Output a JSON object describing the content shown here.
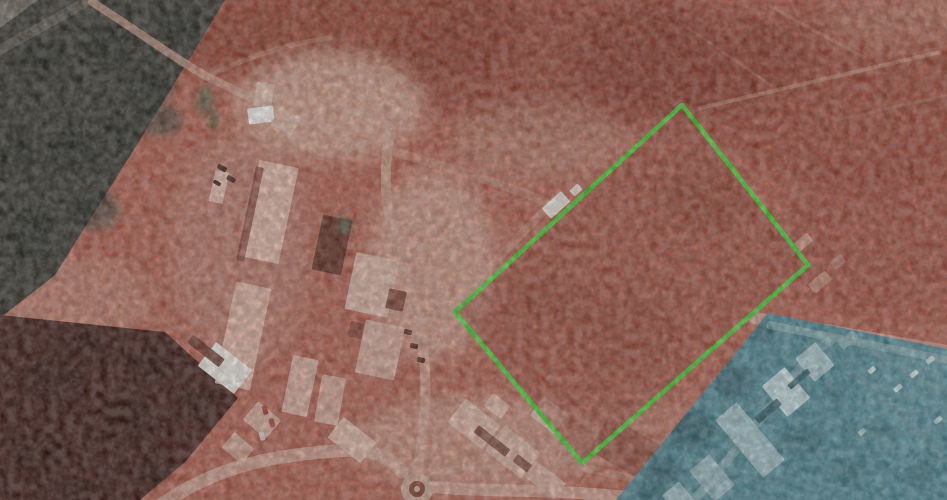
{
  "scene": {
    "type": "annotated-satellite-aerial-photograph",
    "width": 947,
    "height": 500,
    "notes": "red-brown tinted aerial view; bright green quadrilateral outlines a dirt sports field; teal-blue tinted sector in lower right; building compound on left; roundabout at bottom; scrub vegetation in upper-left and lower-left"
  },
  "map": {
    "palette": {
      "base": "#b45b48",
      "boundary_green": "#3ed32a",
      "blue_wash": "#4b8793",
      "road_light": "#d6a28e",
      "building_pink": "#e2b3a1",
      "building_white": "#f4ece2",
      "veg_olive": "#625d4d",
      "veg_dark_red": "#74281b",
      "shadow_dark": "#5e2317"
    },
    "field_boundary": {
      "points": "682,105 808,265 582,463 455,312",
      "stroke": "#3ed32a",
      "stroke_width": 4.5,
      "fill": "#9a4634",
      "fill_opacity": 0.55
    },
    "field_detail": {
      "streak_format": "[path, stroke, width, opacity]",
      "streaks": [
        [
          "M500,302 L688,172",
          "#b5705c",
          6,
          0.22
        ],
        [
          "M543,380 L738,243",
          "#b5705c",
          5,
          0.16
        ],
        [
          "M610,420 L778,282",
          "#b5705c",
          4,
          0.14
        ]
      ],
      "blotch_format": "[cx, cy, rx, ry, fill, opacity]",
      "blotches": [
        [
          700,
          200,
          45,
          30,
          "#8a3a28",
          0.5
        ],
        [
          622,
          330,
          55,
          40,
          "#93402e",
          0.45
        ],
        [
          540,
          300,
          35,
          25,
          "#8e3c2a",
          0.4
        ]
      ]
    },
    "blue_sector": {
      "points": "768,313 947,349 947,500 616,500",
      "fill": "#4b8793",
      "tree_fill": "#2f5f6a",
      "tree_format": "[cx, cy, rx, ry, opacity]",
      "trees": [
        [
          690,
          430,
          24,
          20,
          0.9
        ],
        [
          733,
          382,
          18,
          16,
          0.85
        ],
        [
          662,
          470,
          16,
          14,
          0.9
        ],
        [
          702,
          352,
          14,
          12,
          0.75
        ],
        [
          762,
          332,
          13,
          10,
          0.7
        ],
        [
          802,
          442,
          22,
          16,
          0.5
        ],
        [
          852,
          472,
          17,
          13,
          0.45
        ],
        [
          882,
          432,
          12,
          10,
          0.45
        ],
        [
          922,
          472,
          15,
          11,
          0.45
        ],
        [
          832,
          392,
          11,
          9,
          0.4
        ],
        [
          648,
          492,
          14,
          10,
          0.8
        ]
      ],
      "building_format": "[cx, cy, w, h, rot, fill, opacity?]",
      "buildings": [
        [
          750,
          440,
          28,
          75,
          -40,
          "#9fc2c9"
        ],
        [
          786,
          392,
          30,
          40,
          -40,
          "#c2dcdf"
        ],
        [
          815,
          362,
          26,
          30,
          -40,
          "#a7c9cf"
        ],
        [
          712,
          478,
          26,
          40,
          -40,
          "#94b7bf"
        ],
        [
          680,
          500,
          22,
          30,
          -40,
          "#9abcc3"
        ],
        [
          768,
          411,
          30,
          8,
          -40,
          "#2c5a66",
          0.9
        ],
        [
          799,
          379,
          26,
          6,
          -40,
          "#2c5a66",
          0.85
        ],
        [
          848,
          340,
          20,
          10,
          -40,
          "#8fb3b8",
          0.8
        ]
      ],
      "road_format": "[path, stroke, width, opacity]",
      "roads": [
        [
          "M690,505 C722,468 752,430 782,392 C802,364 817,347 832,340",
          "#7fa6ab",
          9,
          0.8
        ],
        [
          "M770,325 L947,360",
          "#8fb3b8",
          8,
          0.7
        ],
        [
          "M850,372 C892,402 922,432 942,462",
          "#6f9aa0",
          7,
          0.5
        ],
        [
          "M870,349 C900,370 930,386 947,392",
          "#6f9aa0",
          5,
          0.4
        ]
      ],
      "light_patch_format": "[cx, cy, rx, ry, fill, opacity]",
      "light_patches": [
        [
          902,
          405,
          42,
          55,
          "#5d96a1",
          0.55
        ],
        [
          940,
          370,
          30,
          25,
          "#6ba0aa",
          0.5
        ]
      ]
    },
    "vegetation": {
      "top_left": {
        "points": "0,0 225,0 140,140 55,275 0,318",
        "fill": "#625d4d"
      },
      "corner_strip": {
        "points": "0,0 38,0 0,28",
        "fill": "#d9cdb4"
      },
      "corner_band": [
        "M-4,52 L100,-6",
        "#cdbfa6",
        10,
        0.7
      ],
      "olive_blotch_fill": "#3e4034",
      "olive_blotch_format": "[cx, cy, rx, ry]",
      "olive_blotches": [
        [
          40,
          60,
          25,
          18
        ],
        [
          110,
          45,
          30,
          20
        ],
        [
          70,
          150,
          28,
          22
        ],
        [
          30,
          235,
          22,
          28
        ],
        [
          150,
          85,
          26,
          18
        ],
        [
          95,
          210,
          24,
          20
        ],
        [
          178,
          28,
          20,
          14
        ],
        [
          120,
          130,
          20,
          16
        ],
        [
          18,
          150,
          16,
          22
        ],
        [
          160,
          120,
          22,
          16
        ]
      ],
      "bottom_left": {
        "points": "0,315 165,332 238,398 185,462 140,500 0,500",
        "fill": "#74281b"
      },
      "red_blotch_fill": "#571c11",
      "red_blotches": [
        [
          55,
          380,
          32,
          26
        ],
        [
          130,
          420,
          30,
          24
        ],
        [
          35,
          455,
          26,
          20
        ],
        [
          148,
          362,
          24,
          18
        ],
        [
          200,
          405,
          18,
          16
        ],
        [
          88,
          345,
          22,
          16
        ],
        [
          150,
          470,
          22,
          16
        ],
        [
          70,
          490,
          26,
          14
        ]
      ]
    },
    "terrain_patch_format": "[cx, cy, rx, ry, fill, opacity]",
    "terrain_patches": [
      [
        330,
        28,
        190,
        60,
        "#8c3424",
        0.75
      ],
      [
        560,
        60,
        170,
        75,
        "#883122",
        0.6
      ],
      [
        860,
        95,
        160,
        95,
        "#913828",
        0.55
      ],
      [
        888,
        235,
        110,
        85,
        "#9a4130",
        0.5
      ],
      [
        690,
        60,
        120,
        60,
        "#7e2c1e",
        0.45
      ],
      [
        330,
        105,
        95,
        55,
        "#d8a590",
        0.85
      ],
      [
        432,
        265,
        65,
        95,
        "#d6a18d",
        0.8
      ],
      [
        480,
        442,
        130,
        48,
        "#d3a08c",
        0.65
      ],
      [
        60,
        300,
        95,
        42,
        "#c98f7b",
        0.55
      ],
      [
        645,
        432,
        65,
        35,
        "#c58a74",
        0.45
      ],
      [
        900,
        22,
        75,
        28,
        "#c3836e",
        0.5
      ],
      [
        540,
        140,
        90,
        40,
        "#c08a75",
        0.5
      ],
      [
        240,
        250,
        70,
        120,
        "#c79181",
        0.45
      ]
    ],
    "road_format": "[path, stroke, width, opacity]",
    "roads": [
      [
        "M160,505 C215,468 265,456 335,451 C372,448 392,457 402,472",
        "#d6a18f",
        13,
        0.9
      ],
      [
        "M417,471 C426,420 429,378 420,330 C411,288 397,253 389,214 C383,184 386,148 393,116",
        "#d29d8a",
        10,
        0.85
      ],
      [
        "M432,487 C472,491 520,490 560,492 C601,494 632,497 657,501",
        "#d6a18f",
        12,
        0.9
      ],
      [
        "M92,2 C132,27 172,57 206,76 C226,86 241,93 254,99",
        "#cf9c88",
        8,
        0.75
      ],
      [
        "M258,97 C300,118 330,135 356,148",
        "#cf9c88",
        6,
        0.4
      ],
      [
        "M205,78 C240,60 280,45 330,38",
        "#cf9c88",
        5,
        0.35
      ],
      [
        "M700,108 L940,52",
        "#d09a84",
        4,
        0.5
      ],
      [
        "M770,6 L863,57",
        "#cc9480",
        3.5,
        0.4
      ],
      [
        "M688,28 L778,90",
        "#c88f7a",
        3,
        0.3
      ],
      [
        "M836,120 L945,96",
        "#c88f7a",
        3,
        0.3
      ],
      [
        "M452,306 L560,194",
        "#d4a08c",
        8,
        0.4
      ],
      [
        "M585,468 C622,476 650,483 676,491",
        "#d2a08c",
        8,
        0.5
      ],
      [
        "M395,152 C448,167 508,186 544,201",
        "#d09a86",
        9,
        0.45
      ],
      [
        "M430,477 C458,466 488,462 516,462",
        "#cf9d89",
        7,
        0.5
      ],
      [
        "M755,318 L947,351",
        "#cf9f94",
        12,
        0.85
      ]
    ],
    "roundabout": {
      "cx": 417,
      "cy": 489,
      "outer_r": 16,
      "outer_fill": "#cfa390",
      "inner_r": 8,
      "inner_fill": "#7e3526",
      "dot_r": 3,
      "dot_fill": "#d8b09c"
    },
    "building_format": "[cx, cy, w, h, rot, fill, opacity?]",
    "buildings": [
      [
        264,
        95,
        18,
        24,
        10,
        "#e3bdaa"
      ],
      [
        261,
        115,
        26,
        16,
        -8,
        "#fbf7f2"
      ],
      [
        286,
        121,
        24,
        20,
        30,
        "#dfb3a0"
      ],
      [
        219,
        187,
        14,
        32,
        12,
        "#e7bcab"
      ],
      [
        269,
        212,
        40,
        98,
        12,
        "#e5b6a4"
      ],
      [
        250,
        214,
        8,
        96,
        12,
        "#6e2417",
        0.65
      ],
      [
        243,
        336,
        36,
        104,
        12,
        "#e2b19e"
      ],
      [
        332,
        245,
        30,
        56,
        12,
        "#5e2518"
      ],
      [
        372,
        285,
        44,
        58,
        12,
        "#e0b4a2"
      ],
      [
        380,
        350,
        40,
        54,
        12,
        "#d8a795"
      ],
      [
        396,
        300,
        18,
        20,
        12,
        "#6a2a1c",
        0.8
      ],
      [
        356,
        330,
        14,
        16,
        12,
        "#7a3020",
        0.8
      ],
      [
        300,
        386,
        26,
        58,
        12,
        "#dcab99"
      ],
      [
        330,
        400,
        24,
        48,
        10,
        "#d7a391"
      ],
      [
        225,
        368,
        46,
        30,
        38,
        "#f5efe7"
      ],
      [
        206,
        351,
        40,
        10,
        38,
        "#5f2316",
        0.8
      ],
      [
        262,
        420,
        30,
        24,
        40,
        "#d9a896"
      ],
      [
        238,
        448,
        26,
        20,
        40,
        "#d3a08e"
      ],
      [
        352,
        440,
        42,
        26,
        38,
        "#e3b7a6"
      ],
      [
        474,
        424,
        44,
        30,
        38,
        "#e2b5a3"
      ],
      [
        513,
        452,
        46,
        32,
        38,
        "#dcae9c"
      ],
      [
        549,
        415,
        30,
        24,
        38,
        "#e6bcab"
      ],
      [
        492,
        441,
        40,
        9,
        38,
        "#63251a",
        0.75
      ],
      [
        531,
        470,
        40,
        9,
        38,
        "#5e2217",
        0.75
      ],
      [
        545,
        480,
        38,
        20,
        38,
        "#d8a997"
      ],
      [
        556,
        205,
        26,
        14,
        -42,
        "#f2e8df"
      ],
      [
        576,
        190,
        11,
        8,
        -42,
        "#e8d5c8"
      ],
      [
        800,
        245,
        26,
        10,
        -40,
        "#d6a18c",
        0.75
      ],
      [
        820,
        282,
        22,
        12,
        -40,
        "#d4a28e",
        0.65
      ],
      [
        838,
        262,
        14,
        10,
        -40,
        "#cf9b86",
        0.55
      ],
      [
        497,
        406,
        22,
        16,
        38,
        "#dfb2a0"
      ],
      [
        625,
        448,
        60,
        40,
        30,
        "#7c2d1f",
        0.5
      ]
    ],
    "tree_small_fill": "#4a5a3c",
    "trees_small": [
      [
        205,
        100,
        8,
        14
      ],
      [
        213,
        120,
        6,
        9
      ],
      [
        345,
        225,
        7,
        9
      ]
    ],
    "vehicle_format": "[cx, cy, w, h, rot, fill]",
    "vehicles": [
      [
        408,
        332,
        8,
        5,
        12,
        "#5a2418"
      ],
      [
        414,
        346,
        8,
        5,
        12,
        "#4a1d12"
      ],
      [
        421,
        360,
        8,
        5,
        12,
        "#5a2418"
      ],
      [
        222,
        168,
        10,
        5,
        30,
        "#3f1a10"
      ],
      [
        231,
        179,
        9,
        5,
        30,
        "#4a2014"
      ],
      [
        217,
        183,
        8,
        4,
        30,
        "#371609"
      ],
      [
        265,
        410,
        9,
        5,
        75,
        "#a63328"
      ],
      [
        272,
        423,
        9,
        5,
        75,
        "#b8442f"
      ],
      [
        262,
        436,
        9,
        5,
        75,
        "#e3d9ce"
      ],
      [
        930,
        360,
        9,
        5,
        -40,
        "#d9e7e9"
      ],
      [
        914,
        374,
        9,
        5,
        -40,
        "#cfe0e3"
      ],
      [
        898,
        388,
        9,
        5,
        -40,
        "#c5d9dc"
      ],
      [
        872,
        370,
        8,
        5,
        -40,
        "#cddee1"
      ],
      [
        938,
        420,
        9,
        5,
        -40,
        "#bfd5d9"
      ],
      [
        862,
        432,
        8,
        5,
        -40,
        "#b9d0d4"
      ]
    ]
  }
}
